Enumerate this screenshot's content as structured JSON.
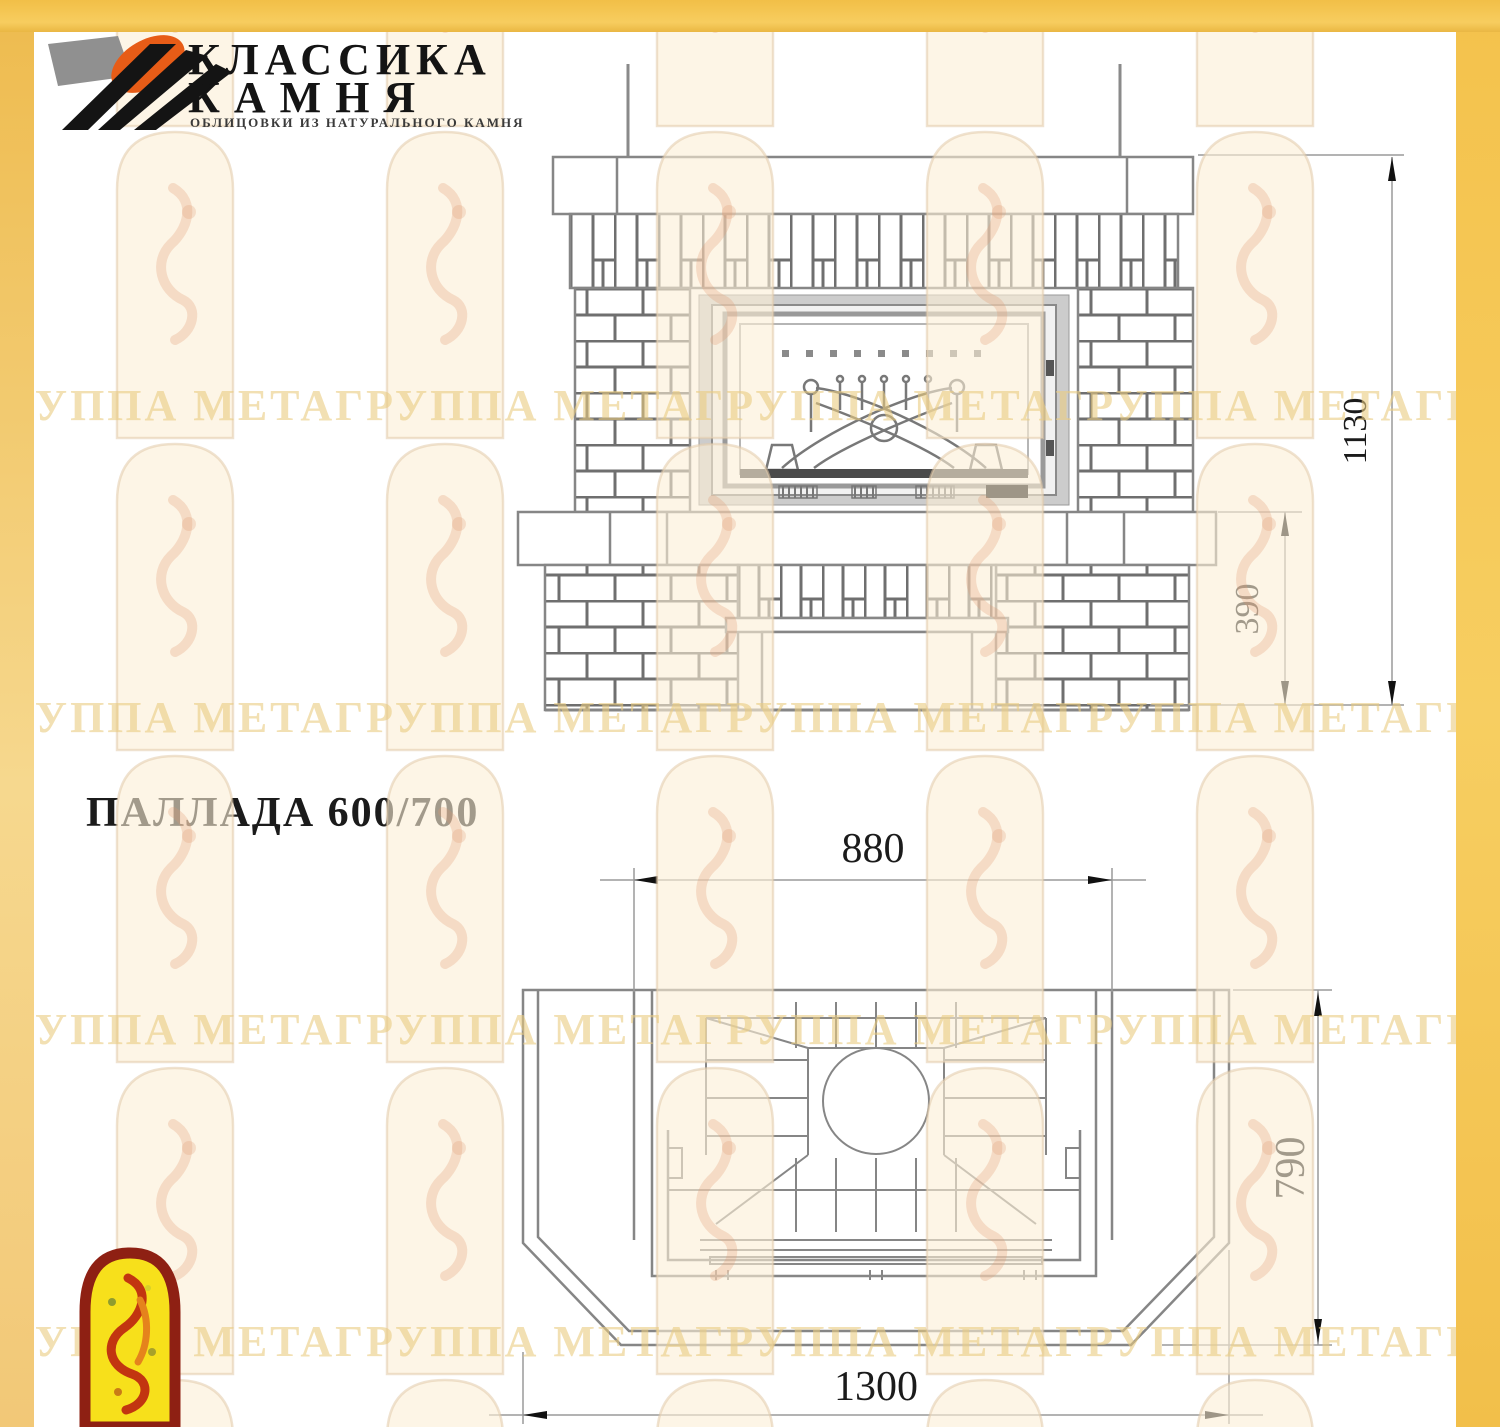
{
  "logo": {
    "line1": "КЛАССИКА",
    "line2": "КАМНЯ",
    "tagline": "ОБЛИЦОВКИ ИЗ НАТУРАЛЬНОГО КАМНЯ",
    "colors": {
      "orange": "#e75c17",
      "gray": "#909090",
      "black": "#141414"
    }
  },
  "drawing": {
    "title": "ПАЛЛАДА 600/700",
    "front_view": {
      "name": "front-elevation",
      "height": "1130",
      "hearth_height": "390"
    },
    "plan_view": {
      "name": "top-plan",
      "portal_width": "880",
      "depth": "790",
      "width": "1300"
    }
  },
  "watermark": {
    "row_text": "ГРУППА МЕТАГРУППА МЕТАГРУППА МЕТАГРУППА МЕТАГРУППА МЕТАГРУППА МЕТА",
    "color": "#e9cb80"
  },
  "page": {
    "frame_color": "#f5c54f",
    "line_color": "#868686",
    "dimension_color": "#9a9a9a"
  }
}
